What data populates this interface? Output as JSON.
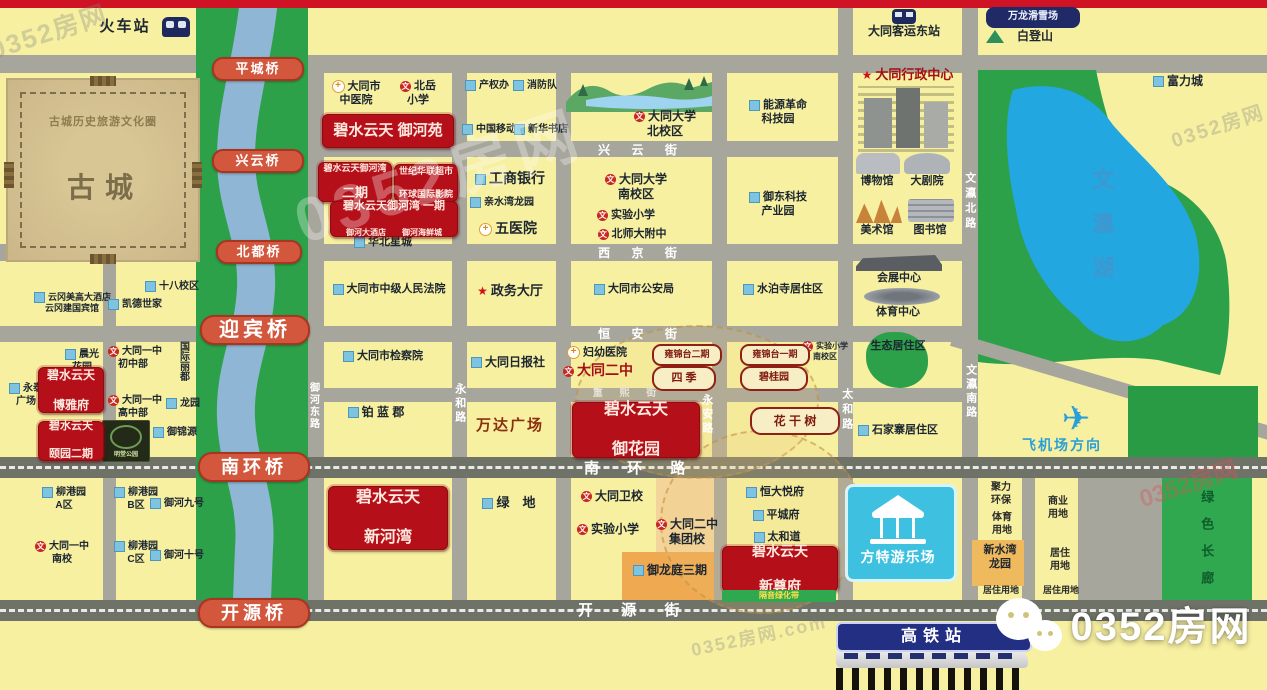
{
  "brand": "0352房网",
  "colors": {
    "background": "#f7f0a1",
    "road": "#a7a69d",
    "main_road": "#6e7267",
    "river_park_green": "#2ca14a",
    "river_blue": "#8fb6d4",
    "lake_blue": "#22a7e0",
    "project_red": "#b5101a",
    "bridge_red": "#d2573d",
    "fangte_cyan": "#3ec1e0",
    "hsr_navy": "#232f83",
    "landuse_orange": "#efa951"
  },
  "labels": [
    {
      "n": "train-station-label",
      "t": "火车站",
      "x": 86,
      "y": 18,
      "w": 78,
      "f": 15,
      "ls": 2
    },
    {
      "n": "bus-station-label",
      "t": "大同客运东站",
      "x": 844,
      "y": 24,
      "w": 120,
      "f": 12
    },
    {
      "n": "wanlong-ski-badge",
      "t": "万龙滑雪场",
      "c": "badge-dk",
      "x": 986,
      "y": 7,
      "w": 86,
      "h": 17,
      "f": 10
    },
    {
      "n": "baideng-mountain-label",
      "t": "白登山",
      "x": 1010,
      "y": 29,
      "w": 50,
      "f": 12
    },
    {
      "n": "fulicheng-label",
      "t": "富力城",
      "x": 1148,
      "y": 74,
      "w": 60,
      "f": 12,
      "i": "bld"
    },
    {
      "n": "old-city-ring-label",
      "t": "古城历史旅游文化圈",
      "x": 28,
      "y": 116,
      "w": 150,
      "f": 11,
      "col": "#8d7c50",
      "ls": 1
    },
    {
      "n": "old-city-label",
      "t": "古城",
      "x": 55,
      "y": 170,
      "w": 100,
      "f": 28,
      "col": "#7c6e4a",
      "ls": 10
    },
    {
      "n": "yungang-hotels-label",
      "t": "云冈美高大酒店\n云冈建国宾馆",
      "x": 34,
      "y": 292,
      "w": 76,
      "f": 9,
      "i": "bld"
    },
    {
      "n": "shiba-campus-label",
      "t": "十八校区",
      "x": 144,
      "y": 281,
      "w": 56,
      "f": 10,
      "i": "bld"
    },
    {
      "n": "kaide-label",
      "t": "凯德世家",
      "x": 106,
      "y": 299,
      "w": 58,
      "f": 10,
      "i": "bld"
    },
    {
      "n": "chenguang-label",
      "t": "晨光\n花园",
      "x": 64,
      "y": 349,
      "w": 36,
      "f": 10,
      "i": "bld"
    },
    {
      "n": "yongtai-label",
      "t": "永泰\n广场",
      "x": 8,
      "y": 383,
      "w": 36,
      "f": 10,
      "i": "bld"
    },
    {
      "n": "boyafu-red-box",
      "t": "碧水云天\n博雅府",
      "c": "red-box",
      "x": 38,
      "y": 367,
      "w": 64,
      "h": 44,
      "f": 12
    },
    {
      "n": "yizhong-junior-label",
      "t": "大同一中\n初中部",
      "x": 108,
      "y": 346,
      "w": 50,
      "f": 10,
      "i": "school"
    },
    {
      "n": "yizhong-senior-label",
      "t": "大同一中\n高中部",
      "x": 108,
      "y": 395,
      "w": 50,
      "f": 10,
      "i": "school"
    },
    {
      "n": "guojilidu-label",
      "t": "国际丽都",
      "x": 176,
      "y": 341,
      "f": 10,
      "v": true,
      "col": "#1c2630"
    },
    {
      "n": "longyuan-label",
      "t": "龙园",
      "x": 166,
      "y": 398,
      "w": 32,
      "f": 10,
      "i": "bld"
    },
    {
      "n": "huitian-label",
      "t": "汇天豪宇",
      "x": 56,
      "y": 405,
      "w": 42,
      "f": 8
    },
    {
      "n": "yiyuan-red-box",
      "t": "碧水云天\n颐园二期",
      "c": "red-box",
      "x": 38,
      "y": 421,
      "w": 64,
      "h": 38,
      "f": 11
    },
    {
      "n": "mingtang-park-image",
      "t": "明堂公园",
      "c": "mingtang",
      "x": 102,
      "y": 420,
      "w": 46,
      "h": 38,
      "f": 6
    },
    {
      "n": "yujinyuan-label",
      "t": "御锦源",
      "x": 152,
      "y": 427,
      "w": 46,
      "f": 10,
      "i": "bld"
    },
    {
      "n": "liugang-a-label",
      "t": "柳港园\nA区",
      "x": 38,
      "y": 487,
      "w": 52,
      "f": 10,
      "i": "bld"
    },
    {
      "n": "yizhong-south-label",
      "t": "大同一中\n南校",
      "x": 34,
      "y": 541,
      "w": 56,
      "f": 10,
      "i": "school"
    },
    {
      "n": "liugang-b-label",
      "t": "柳港园\nB区",
      "x": 110,
      "y": 487,
      "w": 52,
      "f": 10,
      "i": "bld"
    },
    {
      "n": "liugang-c-label",
      "t": "柳港园\nC区",
      "x": 110,
      "y": 541,
      "w": 52,
      "f": 10,
      "i": "bld"
    },
    {
      "n": "yuhe9-label",
      "t": "御河九号",
      "x": 150,
      "y": 498,
      "w": 52,
      "f": 10,
      "i": "bld"
    },
    {
      "n": "yuhe10-label",
      "t": "御河十号",
      "x": 150,
      "y": 550,
      "w": 52,
      "f": 10,
      "i": "bld"
    },
    {
      "n": "zhongyi-hospital-label",
      "t": "大同市\n中医院",
      "x": 328,
      "y": 80,
      "w": 56,
      "f": 11,
      "i": "cross"
    },
    {
      "n": "beiyue-school-label",
      "t": "北岳\n小学",
      "x": 396,
      "y": 80,
      "w": 44,
      "f": 11,
      "i": "school"
    },
    {
      "n": "yuheyuan-red-box",
      "t": "碧水云天 御河苑",
      "c": "red-box",
      "x": 322,
      "y": 114,
      "w": 130,
      "h": 32,
      "f": 15
    },
    {
      "n": "yuhewan2-red-box",
      "t": "碧水云天御河湾\n二期",
      "c": "red-box",
      "x": 318,
      "y": 162,
      "w": 72,
      "h": 38,
      "f": 9,
      "f2": 13
    },
    {
      "n": "shijihualian-red-box",
      "t": "世纪华联超市\n环球国际影院",
      "c": "red-box",
      "x": 394,
      "y": 164,
      "w": 62,
      "h": 36,
      "f": 9
    },
    {
      "n": "yuhewan1-red-box",
      "t": "碧水云天御河湾 一期\n御河大酒店　　御河海鲜城",
      "c": "red-box",
      "x": 330,
      "y": 201,
      "w": 126,
      "h": 34,
      "f": 11,
      "f2": 8
    },
    {
      "n": "huabei-label",
      "t": "华北星城",
      "x": 350,
      "y": 236,
      "w": 66,
      "f": 11,
      "i": "bld"
    },
    {
      "n": "court-label",
      "t": "大同市中级人民法院",
      "x": 324,
      "y": 283,
      "w": 130,
      "f": 11,
      "i": "bld"
    },
    {
      "n": "procuratorate-label",
      "t": "大同市检察院",
      "x": 336,
      "y": 350,
      "w": 94,
      "f": 11,
      "i": "bld"
    },
    {
      "n": "bolanjun-label",
      "t": "铂 蓝 郡",
      "x": 334,
      "y": 405,
      "w": 84,
      "f": 12,
      "i": "bld"
    },
    {
      "n": "xinhewan-red-box",
      "t": "碧水云天\n新河湾",
      "c": "red-box",
      "x": 328,
      "y": 486,
      "w": 118,
      "h": 62,
      "f": 16
    },
    {
      "n": "chanquan-label",
      "t": "产权办",
      "x": 464,
      "y": 80,
      "w": 46,
      "f": 10,
      "i": "bld"
    },
    {
      "n": "fire-brigade-label",
      "t": "消防队",
      "x": 512,
      "y": 80,
      "w": 46,
      "f": 10,
      "i": "bld"
    },
    {
      "n": "china-mobile-label",
      "t": "中国移动",
      "x": 462,
      "y": 124,
      "w": 52,
      "f": 10,
      "i": "bld"
    },
    {
      "n": "xinhua-bookstore-label",
      "t": "新华书店",
      "x": 514,
      "y": 124,
      "w": 52,
      "f": 10,
      "i": "bld"
    },
    {
      "n": "icbc-label",
      "t": "工商银行",
      "x": 468,
      "y": 170,
      "w": 84,
      "f": 14,
      "i": "bld"
    },
    {
      "n": "qinshuiwan-label",
      "t": "亲水湾龙园",
      "x": 466,
      "y": 197,
      "w": 72,
      "f": 10,
      "i": "bld"
    },
    {
      "n": "no5-hospital-label",
      "t": "五医院",
      "x": 474,
      "y": 220,
      "w": 68,
      "f": 14,
      "i": "cross"
    },
    {
      "n": "zhengwu-hall-label",
      "t": "政务大厅",
      "x": 466,
      "y": 283,
      "w": 88,
      "f": 13,
      "i": "star"
    },
    {
      "n": "daily-press-label",
      "t": "大同日报社",
      "x": 468,
      "y": 355,
      "w": 80,
      "f": 12,
      "i": "bld"
    },
    {
      "n": "wanda-plaza-label",
      "t": "万达广场",
      "x": 466,
      "y": 417,
      "w": 88,
      "f": 15,
      "col": "#8a2f10",
      "ls": 2
    },
    {
      "n": "lvdi-label",
      "t": "绿　地",
      "x": 472,
      "y": 495,
      "w": 74,
      "f": 13,
      "i": "bld"
    },
    {
      "n": "dtu-north-label",
      "t": "大同大学\n北校区",
      "x": 628,
      "y": 109,
      "w": 74,
      "f": 12,
      "i": "school"
    },
    {
      "n": "xingyun-street-label",
      "t": "兴 云 街",
      "c": "road-label",
      "x": 592,
      "y": 143,
      "w": 100,
      "f": 12,
      "ls": 9
    },
    {
      "n": "dtu-south-label",
      "t": "大同大学\n南校区",
      "x": 598,
      "y": 172,
      "w": 76,
      "f": 12,
      "i": "school"
    },
    {
      "n": "shiyan-school1-label",
      "t": "实验小学",
      "x": 594,
      "y": 209,
      "w": 64,
      "f": 11,
      "i": "school"
    },
    {
      "n": "beishida-label",
      "t": "北师大附中",
      "x": 594,
      "y": 228,
      "w": 76,
      "f": 11,
      "i": "school"
    },
    {
      "n": "xijing-street-label",
      "t": "西 京 街",
      "c": "road-label",
      "x": 592,
      "y": 246,
      "w": 100,
      "f": 12,
      "ls": 9
    },
    {
      "n": "police-bureau-label",
      "t": "大同市公安局",
      "x": 586,
      "y": 283,
      "w": 96,
      "f": 11,
      "i": "bld"
    },
    {
      "n": "hengan-street-label",
      "t": "恒 安 街",
      "c": "road-label",
      "x": 592,
      "y": 327,
      "w": 100,
      "f": 12,
      "ls": 9
    },
    {
      "n": "fuyou-hospital-label",
      "t": "妇幼医院",
      "x": 560,
      "y": 346,
      "w": 74,
      "f": 11,
      "i": "cross"
    },
    {
      "n": "erzhong-label",
      "t": "大同二中",
      "c": "poi poi-red",
      "x": 556,
      "y": 362,
      "w": 84,
      "f": 14,
      "i": "school"
    },
    {
      "n": "yongjintai2-badge",
      "t": "雍锦台二期",
      "c": "badge",
      "x": 652,
      "y": 344,
      "w": 60,
      "h": 16
    },
    {
      "n": "siji-badge",
      "t": "四 季",
      "c": "badge badge-lg",
      "x": 652,
      "y": 366,
      "w": 52,
      "h": 17,
      "f": 11
    },
    {
      "n": "zhongxi-street-label",
      "t": "重 熙 街",
      "c": "road-label-dim",
      "x": 590,
      "y": 388,
      "w": 76,
      "f": 10,
      "ls": 7
    },
    {
      "n": "yuhuayuan-red-box",
      "t": "碧水云天\n御花园",
      "c": "red-box",
      "x": 572,
      "y": 402,
      "w": 126,
      "h": 54,
      "f": 16
    },
    {
      "n": "weixiao-label",
      "t": "大同卫校",
      "x": 578,
      "y": 489,
      "w": 68,
      "f": 12,
      "i": "school"
    },
    {
      "n": "shiyan-school2-label",
      "t": "实验小学",
      "x": 574,
      "y": 522,
      "w": 68,
      "f": 12,
      "i": "school"
    },
    {
      "n": "erzhong-jituan-label",
      "t": "大同二中\n集团校",
      "x": 648,
      "y": 517,
      "w": 78,
      "f": 12,
      "i": "school"
    },
    {
      "n": "yulongting-label",
      "t": "御龙庭三期",
      "x": 628,
      "y": 563,
      "w": 84,
      "f": 12,
      "i": "bld"
    },
    {
      "n": "nengyuan-park-label",
      "t": "能源革命\n科技园",
      "x": 740,
      "y": 99,
      "w": 76,
      "f": 11,
      "i": "bld"
    },
    {
      "n": "yudong-park-label",
      "t": "御东科技\n产业园",
      "x": 740,
      "y": 191,
      "w": 76,
      "f": 11,
      "i": "bld"
    },
    {
      "n": "shuiposi-label",
      "t": "水泊寺居住区",
      "x": 736,
      "y": 283,
      "w": 94,
      "f": 11,
      "i": "bld"
    },
    {
      "n": "yongjintai1-badge",
      "t": "雍锦台一期",
      "c": "badge",
      "x": 740,
      "y": 344,
      "w": 60,
      "h": 16
    },
    {
      "n": "shiyan-south-label",
      "t": "实验小学\n南校区",
      "x": 802,
      "y": 341,
      "w": 46,
      "f": 8,
      "i": "school"
    },
    {
      "n": "biguiyuan-badge",
      "t": "碧桂园",
      "c": "badge badge-lg",
      "x": 740,
      "y": 366,
      "w": 56,
      "h": 17,
      "f": 10
    },
    {
      "n": "huaganshu-badge",
      "t": "花 干 树",
      "c": "badge badge-lg",
      "x": 750,
      "y": 407,
      "w": 78,
      "h": 20,
      "f": 12
    },
    {
      "n": "hengda-label",
      "t": "恒大悦府",
      "x": 742,
      "y": 486,
      "w": 66,
      "f": 11,
      "i": "bld"
    },
    {
      "n": "pingchengfu-label",
      "t": "平城府",
      "x": 746,
      "y": 509,
      "w": 60,
      "f": 11,
      "i": "bld"
    },
    {
      "n": "taihedao-label",
      "t": "太和道",
      "x": 748,
      "y": 531,
      "w": 58,
      "f": 11,
      "i": "bld"
    },
    {
      "n": "xinzunfu-red-box",
      "t": "碧水云天\n新尊府",
      "c": "red-box",
      "x": 722,
      "y": 546,
      "w": 114,
      "h": 44,
      "f": 14
    },
    {
      "n": "geyin-greenbelt-label",
      "t": "隔音绿化带",
      "c": "green-strip",
      "x": 722,
      "y": 590,
      "w": 114,
      "h": 12,
      "f": 8
    },
    {
      "n": "admin-center-label",
      "t": "大同行政中心",
      "c": "poi poi-red",
      "x": 850,
      "y": 67,
      "w": 115,
      "f": 13,
      "i": "star"
    },
    {
      "n": "museum-label",
      "t": "博物馆",
      "x": 854,
      "y": 175,
      "w": 46,
      "f": 11
    },
    {
      "n": "theatre-label",
      "t": "大剧院",
      "x": 904,
      "y": 175,
      "w": 46,
      "f": 11
    },
    {
      "n": "art-gallery-label",
      "t": "美术馆",
      "x": 854,
      "y": 224,
      "w": 46,
      "f": 11
    },
    {
      "n": "library-label",
      "t": "图书馆",
      "x": 906,
      "y": 224,
      "w": 48,
      "f": 11
    },
    {
      "n": "expo-center-label",
      "t": "会展中心",
      "x": 864,
      "y": 272,
      "w": 70,
      "f": 11
    },
    {
      "n": "sports-center-label",
      "t": "体育中心",
      "x": 862,
      "y": 306,
      "w": 72,
      "f": 11
    },
    {
      "n": "eco-district-label",
      "t": "生态居住区",
      "x": 858,
      "y": 340,
      "w": 80,
      "f": 11,
      "z": 5
    },
    {
      "n": "shijiazhai-label",
      "t": "石家寨居住区",
      "x": 850,
      "y": 424,
      "w": 96,
      "f": 11,
      "i": "bld"
    },
    {
      "n": "fangte-label",
      "t": "方特游乐场",
      "c": "plain",
      "x": 847,
      "y": 549,
      "w": 102,
      "f": 14,
      "ls": 1,
      "z": 6
    },
    {
      "n": "wenying-north-road-label",
      "t": "文瀛北路",
      "c": "vert",
      "x": 962,
      "y": 172,
      "f": 11,
      "v": true,
      "ls": 4
    },
    {
      "n": "wenying-south-road-label",
      "t": "文瀛南路",
      "c": "vert",
      "x": 963,
      "y": 364,
      "f": 11,
      "v": true,
      "ls": 3
    },
    {
      "n": "taihe-road-label",
      "t": "太和路",
      "c": "vert",
      "x": 839,
      "y": 388,
      "f": 11,
      "v": true,
      "ls": 4
    },
    {
      "n": "yonghe-road-label",
      "t": "永和路",
      "c": "vert",
      "x": 452,
      "y": 383,
      "f": 11,
      "v": true,
      "ls": 3
    },
    {
      "n": "yongan-road-label",
      "t": "永安路",
      "c": "vert",
      "x": 699,
      "y": 394,
      "f": 11,
      "v": true,
      "ls": 3
    },
    {
      "n": "yuhedong-road-label",
      "t": "御河东路",
      "c": "vert",
      "x": 306,
      "y": 382,
      "f": 10,
      "v": true,
      "ls": 2
    },
    {
      "n": "wenying-lake-label",
      "t": "文瀛湖",
      "c": "lake-name",
      "x": 1088,
      "y": 168,
      "f": 22,
      "v": true,
      "ls": 22,
      "col": "#3e97cf"
    },
    {
      "n": "airport-direction-label",
      "t": "飞机场方向",
      "x": 1002,
      "y": 437,
      "w": 120,
      "f": 14,
      "col": "#2a9fd8",
      "ls": 2,
      "z": 5
    },
    {
      "n": "plane-icon",
      "t": "✈",
      "x": 1046,
      "y": 398,
      "w": 60,
      "f": 34,
      "col": "#2a9fd8",
      "z": 5
    },
    {
      "n": "juli-landuse-label",
      "t": "聚力\n环保",
      "c": "landuse",
      "x": 980,
      "y": 482,
      "w": 42
    },
    {
      "n": "tiyu-landuse-label",
      "t": "体育\n用地",
      "c": "landuse",
      "x": 982,
      "y": 512,
      "w": 40
    },
    {
      "n": "shangye-landuse-label",
      "t": "商业\n用地",
      "c": "landuse",
      "x": 1038,
      "y": 496,
      "w": 40
    },
    {
      "n": "xinshuiwan-label",
      "t": "新水湾\n龙园",
      "x": 974,
      "y": 544,
      "w": 52,
      "f": 11,
      "z": 5
    },
    {
      "n": "juzhu-landuse-label-1",
      "t": "居住\n用地",
      "c": "landuse",
      "x": 1040,
      "y": 548,
      "w": 40
    },
    {
      "n": "juzhu-landuse-label-2",
      "t": "居住用地",
      "c": "landuse",
      "x": 974,
      "y": 585,
      "w": 54,
      "f": 9
    },
    {
      "n": "juzhu-landuse-label-3",
      "t": "居住用地",
      "c": "landuse",
      "x": 1034,
      "y": 585,
      "w": 54,
      "f": 9
    },
    {
      "n": "green-corridor-label",
      "t": "绿色长廊",
      "x": 1198,
      "y": 490,
      "f": 13,
      "v": true,
      "ls": 14,
      "col": "#0e5d2b",
      "z": 5
    },
    {
      "n": "nanhuan-road-label",
      "t": "南 环 路",
      "c": "road-label",
      "x": 584,
      "y": 460,
      "w": 110,
      "f": 15,
      "ls": 12,
      "z": 3
    },
    {
      "n": "kaiyuan-street-label",
      "t": "开 源 街",
      "c": "road-label",
      "x": 578,
      "y": 602,
      "w": 110,
      "f": 15,
      "ls": 12,
      "z": 3
    },
    {
      "n": "hsr-station-sign",
      "t": "高铁站",
      "c": "hsr",
      "x": 836,
      "y": 622,
      "w": 192,
      "h": 26,
      "f": 16
    },
    {
      "n": "brand-logo-text",
      "t": "0352房网",
      "c": "brand",
      "x": 1058,
      "y": 602,
      "w": 206,
      "f": 40
    },
    {
      "n": "pingcheng-bridge",
      "t": "平城桥",
      "c": "bridge",
      "x": 212,
      "y": 57,
      "w": 88,
      "f": 13
    },
    {
      "n": "xingyun-bridge",
      "t": "兴云桥",
      "c": "bridge",
      "x": 212,
      "y": 149,
      "w": 88,
      "f": 13
    },
    {
      "n": "beidu-bridge",
      "t": "北都桥",
      "c": "bridge",
      "x": 216,
      "y": 240,
      "w": 82,
      "f": 13
    },
    {
      "n": "yingbin-bridge",
      "t": "迎宾桥",
      "c": "bridge bridge-lg",
      "x": 200,
      "y": 315,
      "w": 106,
      "f": 20
    },
    {
      "n": "nanhuan-bridge",
      "t": "南环桥",
      "c": "bridge bridge-lg",
      "x": 198,
      "y": 452,
      "w": 108,
      "f": 18
    },
    {
      "n": "kaiyuan-bridge",
      "t": "开源桥",
      "c": "bridge bridge-lg",
      "x": 198,
      "y": 598,
      "w": 108,
      "f": 18
    },
    {
      "n": "watermark-topleft",
      "t": "0352房网",
      "c": "wm",
      "x": -12,
      "y": 16,
      "f": 26,
      "rot": -18
    },
    {
      "n": "watermark-center",
      "t": "0352房网",
      "c": "wm2",
      "x": 290,
      "y": 140,
      "f": 62,
      "rot": -18
    },
    {
      "n": "watermark-right",
      "t": "0352房网",
      "c": "wm3",
      "x": 1138,
      "y": 470,
      "f": 24,
      "rot": -18
    },
    {
      "n": "watermark-topright",
      "t": "0352房网",
      "c": "wm",
      "x": 1170,
      "y": 115,
      "f": 20,
      "rot": -18
    },
    {
      "n": "watermark-bottom",
      "t": "0352房网.com",
      "c": "wm",
      "x": 690,
      "y": 625,
      "f": 18,
      "rot": -12
    }
  ]
}
